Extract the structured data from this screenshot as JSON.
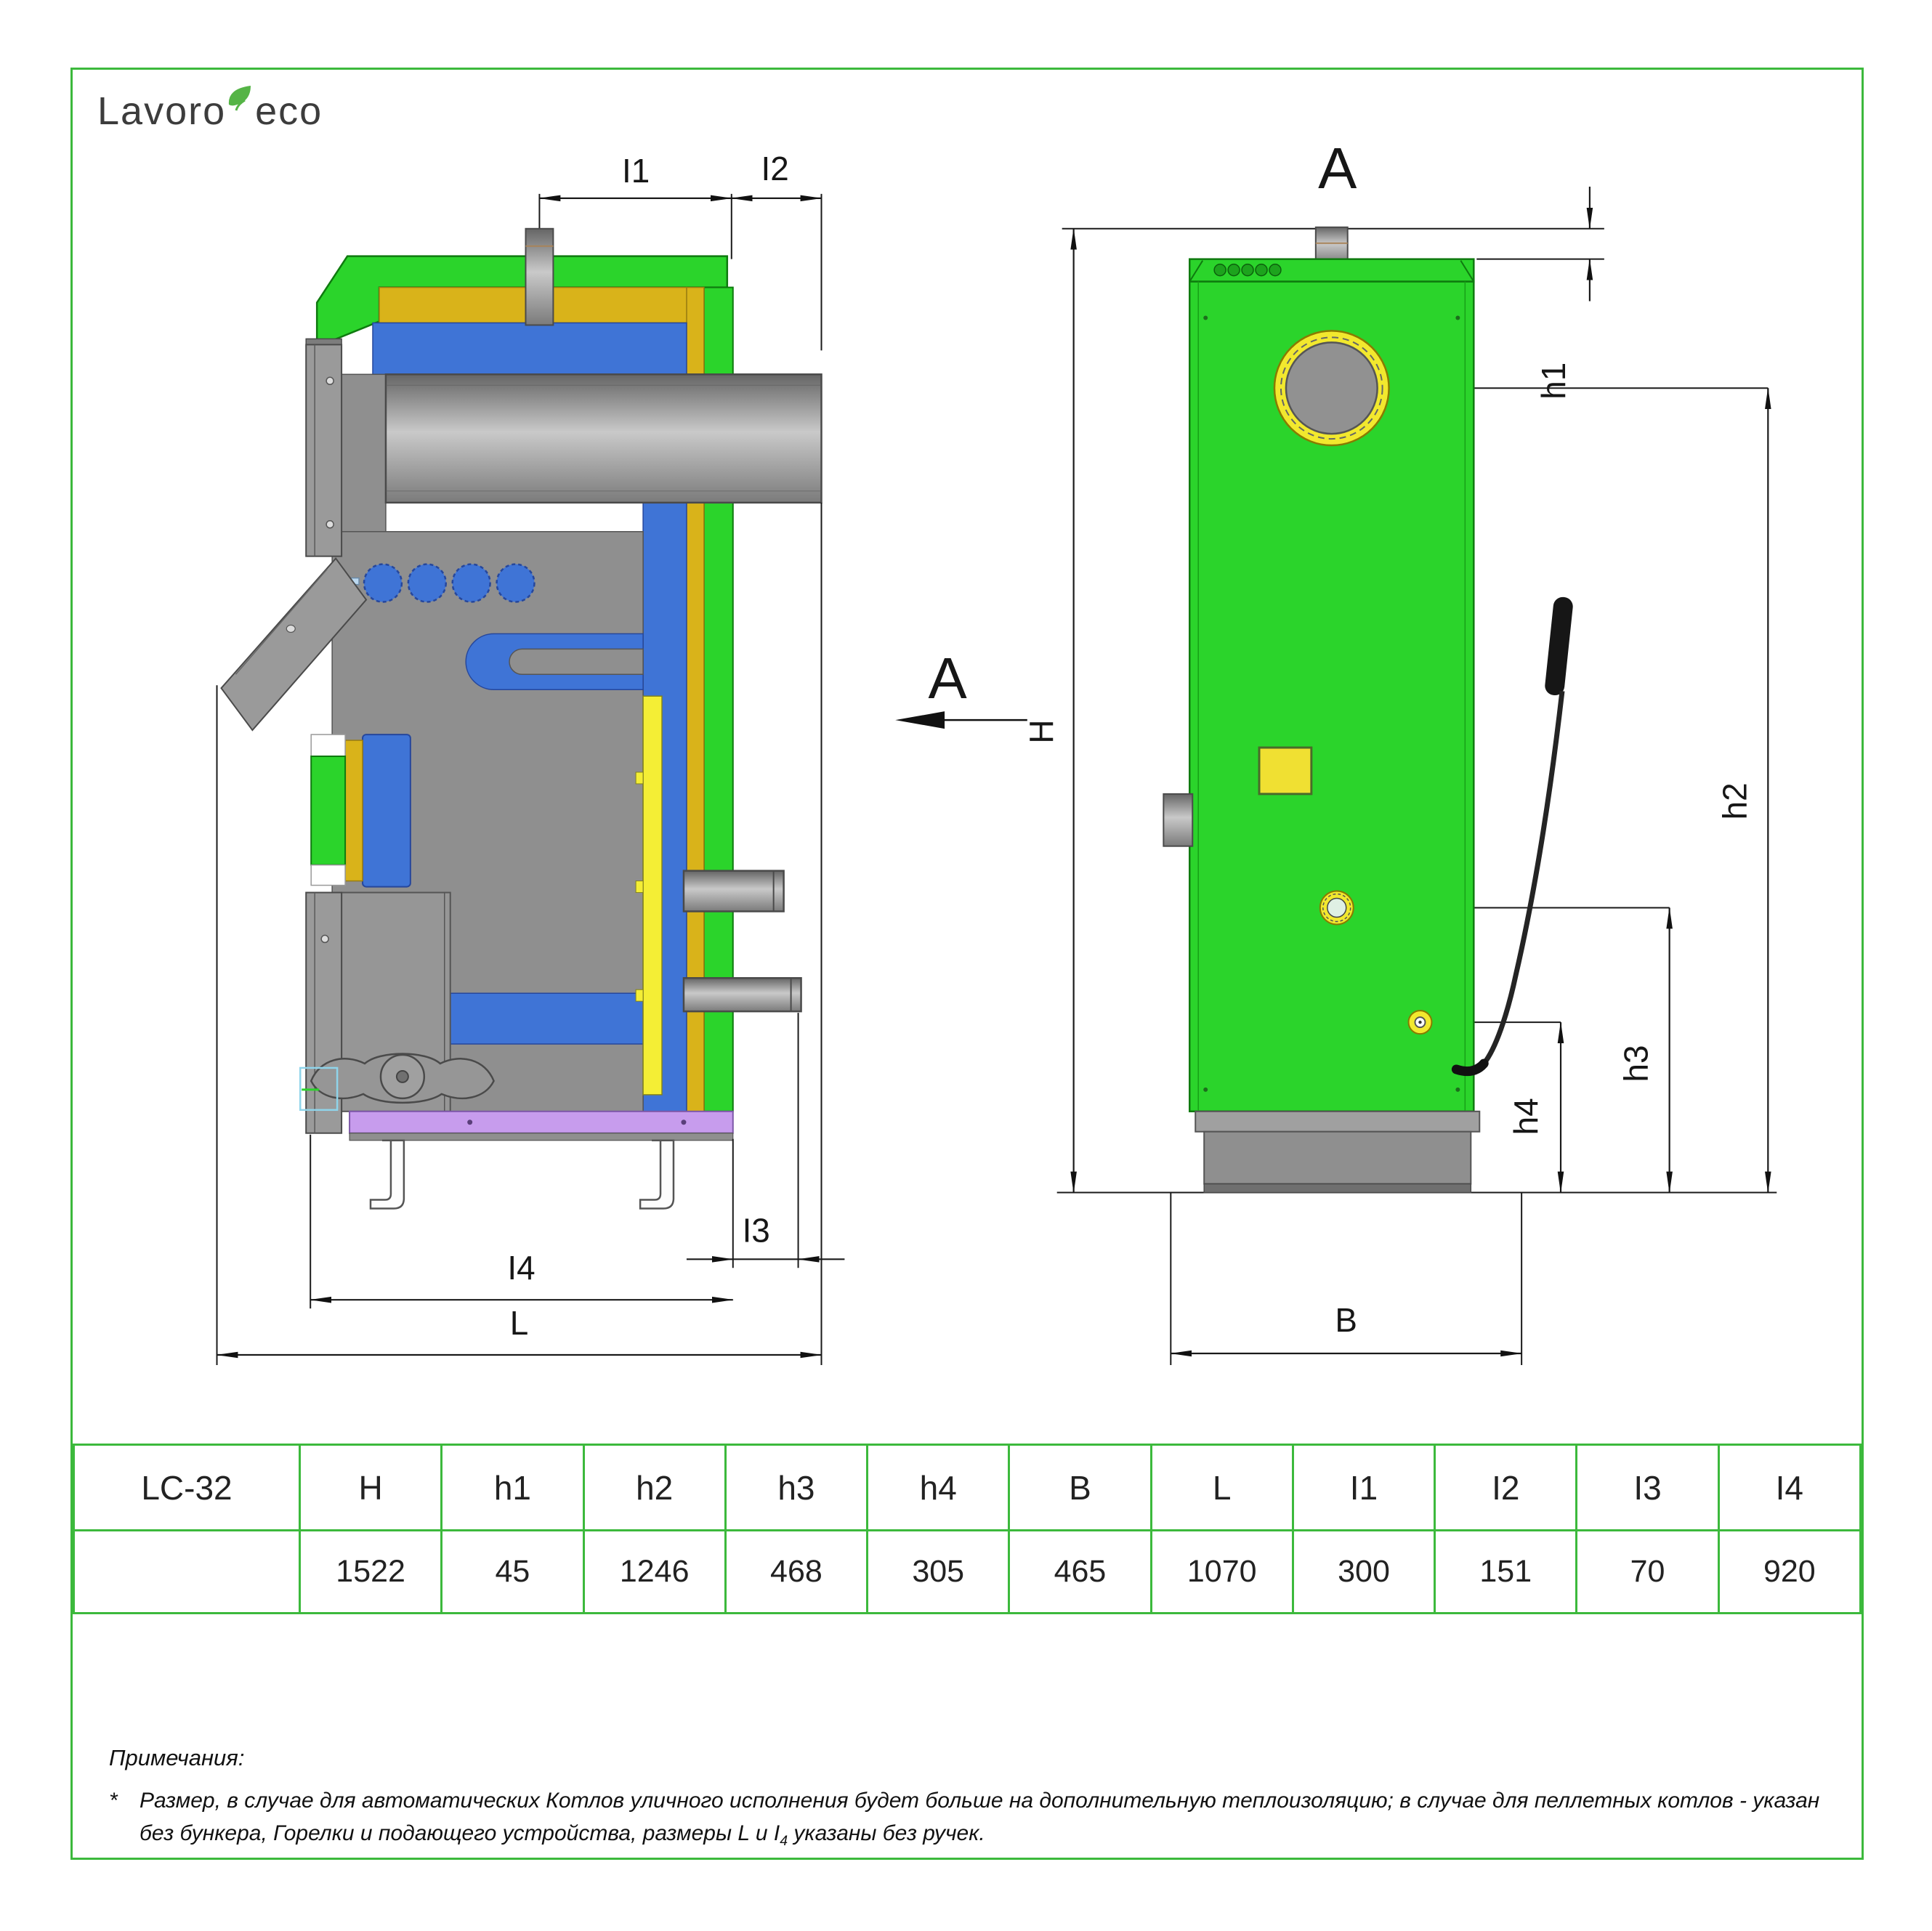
{
  "logo": {
    "part1": "Lavoro",
    "part2": "eco",
    "leaf_icon": "leaf-icon"
  },
  "drawing": {
    "section_label": "A",
    "view_label": "A",
    "left": {
      "i1": "I1",
      "i2": "I2",
      "i3": "I3",
      "i4": "I4",
      "l": "L"
    },
    "right": {
      "h": "H",
      "h1": "h1",
      "h2": "h2",
      "h3": "h3",
      "h4": "h4",
      "b": "B"
    }
  },
  "table": {
    "model": "LC-32",
    "headers": [
      "H",
      "h1",
      "h2",
      "h3",
      "h4",
      "B",
      "L",
      "I1",
      "I2",
      "I3",
      "I4"
    ],
    "values": [
      "1522",
      "45",
      "1246",
      "468",
      "305",
      "465",
      "1070",
      "300",
      "151",
      "70",
      "920"
    ]
  },
  "notes": {
    "title": "Примечания:",
    "star": "*",
    "body_before": "Размер, в случае для автоматических Котлов уличного исполнения будет больше на дополнительную теплоизоляцию; в случае для пеллетных котлов - указан без бункера, Горелки и подающего устройства, размеры L и I",
    "sub": "4",
    "body_after": " указаны без ручек."
  },
  "colors": {
    "frame_green": "#3cb93c",
    "body_green": "#2bd42b",
    "insulation_gold": "#d9b31a",
    "water_blue": "#3f74d6",
    "metal_gray": "#8f8f8f",
    "base_purple": "#c79ced",
    "accent_yellow": "#f2e82e",
    "leaf_green": "#55b446"
  }
}
